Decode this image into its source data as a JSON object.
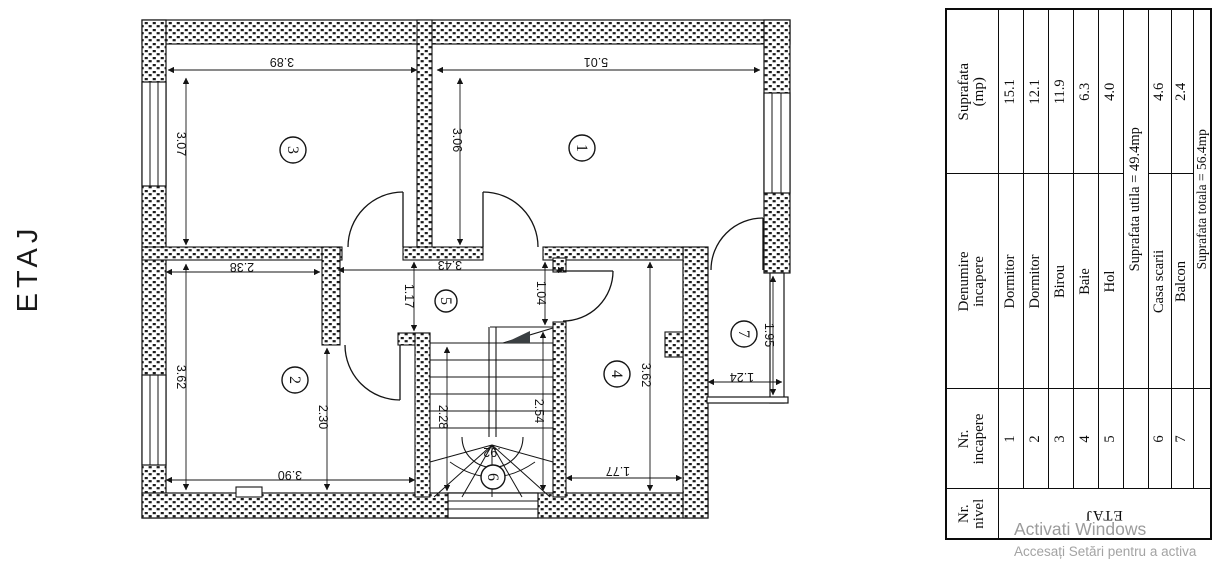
{
  "floor_title": "ETAJ",
  "plan": {
    "rooms": [
      {
        "number": "1"
      },
      {
        "number": "2"
      },
      {
        "number": "3"
      },
      {
        "number": "4"
      },
      {
        "number": "5"
      },
      {
        "number": "6"
      },
      {
        "number": "7"
      }
    ],
    "dims": {
      "d389": "3.89",
      "d501": "5.01",
      "d307": "3.07",
      "d306": "3.06",
      "d238": "2.38",
      "d343": "3.43",
      "d117": "1.17",
      "d104": "1.04",
      "d362a": "3.62",
      "d230": "2.30",
      "d390": "3.90",
      "d228": "2.28",
      "d254": "2.54",
      "d92": ".92",
      "d362b": "3.62",
      "d177": "1.77",
      "d195": "1.95",
      "d124": "1.24"
    }
  },
  "table": {
    "headers": {
      "nivel1": "Nr.",
      "nivel2": "nivel",
      "incapere1": "Nr.",
      "incapere2": "incapere",
      "denumire1": "Denumire",
      "denumire2": "incapere",
      "suprafata1": "Suprafata",
      "suprafata2": "(mp)"
    },
    "level_label": "ETAJ",
    "rows": [
      {
        "nr": "1",
        "name": "Dormitor",
        "area": "15.1"
      },
      {
        "nr": "2",
        "name": "Dormitor",
        "area": "12.1"
      },
      {
        "nr": "3",
        "name": "Birou",
        "area": "11.9"
      },
      {
        "nr": "4",
        "name": "Baie",
        "area": "6.3"
      },
      {
        "nr": "5",
        "name": "Hol",
        "area": "4.0"
      },
      {
        "span": "Suprafata utila = 49.4mp"
      },
      {
        "nr": "6",
        "name": "Casa scarii",
        "area": "4.6"
      },
      {
        "nr": "7",
        "name": "Balcon",
        "area": "2.4"
      },
      {
        "span": "Suprafata totala = 56.4mp"
      }
    ]
  },
  "watermark": {
    "line1": "Activati Windows",
    "line2": "Accesați Setări pentru a activa"
  }
}
